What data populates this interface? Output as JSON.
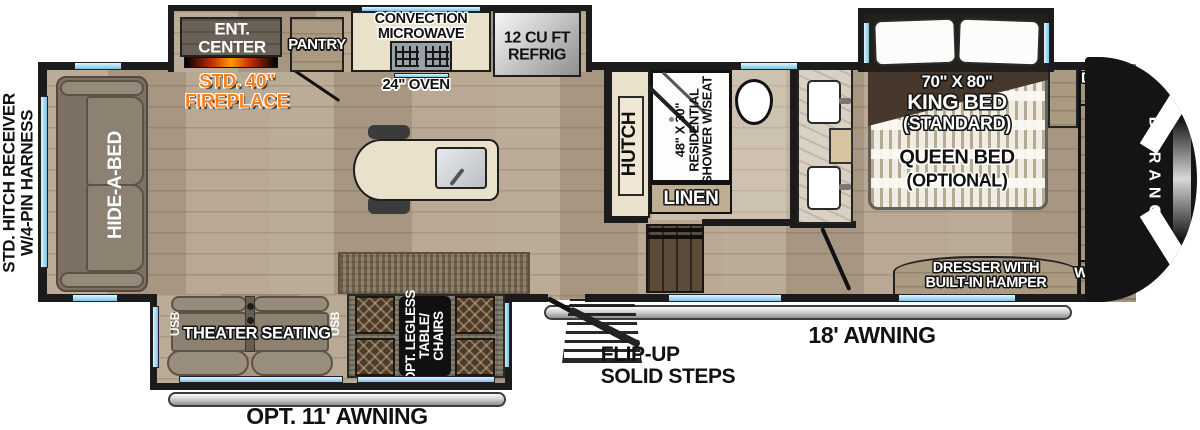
{
  "colors": {
    "wall": "#1b1b1b",
    "win": "#a8daf3",
    "floor_mid": "#b4a48e",
    "cream": "#eae1cb",
    "wood_dark": "#6b6051",
    "taupe": "#8d8172",
    "orange": "#f5821f",
    "mattress": "#f0ede4",
    "headboard": "#46382c",
    "stairs": "#4f3d2c",
    "rugbrown": "#85765f",
    "ruggray": "#7c7668"
  },
  "exterior": {
    "hitch_line1": "STD. HITCH RECEIVER",
    "hitch_line2": "W/4-PIN HARNESS",
    "main_awning_label": "18' AWNING",
    "opt_awning_label": "OPT. 11' AWNING",
    "steps_line1": "FLIP-UP",
    "steps_line2": "SOLID STEPS",
    "brand_vertical": "DURANGO"
  },
  "living": {
    "sofa_label": "HIDE-A-BED",
    "ent_center_line1": "ENT.",
    "ent_center_line2": "CENTER",
    "fireplace_line1": "STD. 40\"",
    "fireplace_line2": "FIREPLACE",
    "theater_label": "THEATER SEATING",
    "usb_left": "USB",
    "usb_right": "USB",
    "table_line1": "OPT. LEGLESS",
    "table_line2": "TABLE/",
    "table_line3": "CHAIRS"
  },
  "kitchen": {
    "pantry_label": "PANTRY",
    "microwave_line1": "CONVECTION",
    "microwave_line2": "MICROWAVE",
    "oven_label": "24\" OVEN",
    "fridge_line1": "12 CU FT",
    "fridge_line2": "REFRIG",
    "hutch_label": "HUTCH"
  },
  "bath": {
    "shower_line1": "48\" X 30\"",
    "shower_line2": "RESIDENTIAL",
    "shower_line3": "SHOWER W/SEAT",
    "linen_label": "LINEN"
  },
  "bedroom": {
    "bed_line1": "70\" X 80\"",
    "bed_line2": "KING BED",
    "bed_line3": "(STANDARD)",
    "bed_line4": "QUEEN BED",
    "bed_line5": "(OPTIONAL)",
    "dresser_line1": "DRESSER WITH",
    "dresser_line2": "BUILT-IN HAMPER"
  },
  "closet": {
    "dryer_line1": "DRYER",
    "dryer_line2": "PREP",
    "washer_line1": "WASHER",
    "washer_line2": "PREP",
    "hanger_colors": [
      "#e8920e",
      "#e6e6e6",
      "#2e7d44",
      "#b3271c",
      "#23539e",
      "#d6c5a0",
      "#c0c0c0",
      "#2e7d44",
      "#b3271c",
      "#23539e",
      "#d6c5a0",
      "#e6e6e6",
      "#8c1f12",
      "#23539e",
      "#e8920e",
      "#c0c0c0",
      "#2e7d44"
    ]
  }
}
